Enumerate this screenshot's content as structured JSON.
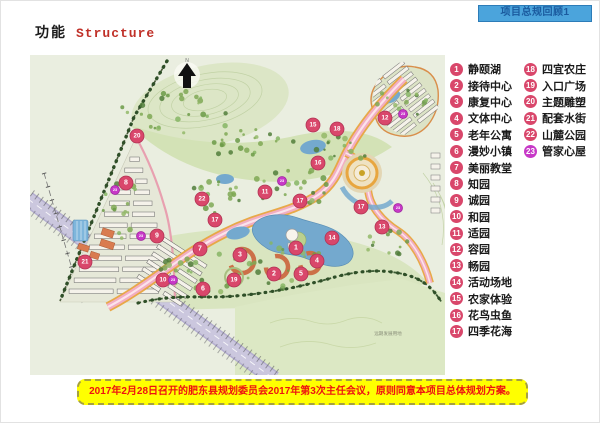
{
  "header": {
    "tab_label": "项目总规回顾1"
  },
  "title": {
    "zh": "功能",
    "en": "Structure"
  },
  "legend": {
    "column1": [
      {
        "num": "1",
        "label": "静颐湖"
      },
      {
        "num": "2",
        "label": "接待中心"
      },
      {
        "num": "3",
        "label": "康复中心"
      },
      {
        "num": "4",
        "label": "文体中心"
      },
      {
        "num": "5",
        "label": "老年公寓"
      },
      {
        "num": "6",
        "label": "漫妙小镇"
      },
      {
        "num": "7",
        "label": "美丽教堂"
      },
      {
        "num": "8",
        "label": "知园"
      },
      {
        "num": "9",
        "label": "诚园"
      },
      {
        "num": "10",
        "label": "和园"
      },
      {
        "num": "11",
        "label": "适园"
      },
      {
        "num": "12",
        "label": "容园"
      },
      {
        "num": "13",
        "label": "畅园"
      },
      {
        "num": "14",
        "label": "活动场地"
      },
      {
        "num": "15",
        "label": "农家体验"
      },
      {
        "num": "16",
        "label": "花鸟虫鱼"
      },
      {
        "num": "17",
        "label": "四季花海"
      }
    ],
    "column2": [
      {
        "num": "18",
        "label": "四宜农庄"
      },
      {
        "num": "19",
        "label": "入口广场"
      },
      {
        "num": "20",
        "label": "主题雕塑"
      },
      {
        "num": "21",
        "label": "配套水街"
      },
      {
        "num": "22",
        "label": "山麓公园"
      },
      {
        "num": "23",
        "label": "管家心屋",
        "magenta": true
      }
    ]
  },
  "map": {
    "north_label": "N",
    "future_land_label": "远期发展用地",
    "markers": [
      {
        "n": "1",
        "x": 266,
        "y": 193,
        "t": "p"
      },
      {
        "n": "2",
        "x": 244,
        "y": 219,
        "t": "p"
      },
      {
        "n": "3",
        "x": 210,
        "y": 200,
        "t": "p"
      },
      {
        "n": "4",
        "x": 287,
        "y": 206,
        "t": "p"
      },
      {
        "n": "5",
        "x": 271,
        "y": 219,
        "t": "p"
      },
      {
        "n": "6",
        "x": 173,
        "y": 234,
        "t": "p"
      },
      {
        "n": "7",
        "x": 170,
        "y": 194,
        "t": "p"
      },
      {
        "n": "8",
        "x": 96,
        "y": 128,
        "t": "p"
      },
      {
        "n": "9",
        "x": 127,
        "y": 181,
        "t": "p"
      },
      {
        "n": "10",
        "x": 133,
        "y": 225,
        "t": "p"
      },
      {
        "n": "11",
        "x": 235,
        "y": 137,
        "t": "p"
      },
      {
        "n": "12",
        "x": 355,
        "y": 63,
        "t": "p"
      },
      {
        "n": "13",
        "x": 352,
        "y": 172,
        "t": "p"
      },
      {
        "n": "14",
        "x": 302,
        "y": 183,
        "t": "p"
      },
      {
        "n": "15",
        "x": 283,
        "y": 70,
        "t": "p"
      },
      {
        "n": "16",
        "x": 288,
        "y": 108,
        "t": "p"
      },
      {
        "n": "17",
        "x": 185,
        "y": 165,
        "t": "p"
      },
      {
        "n": "17",
        "x": 270,
        "y": 146,
        "t": "p"
      },
      {
        "n": "17",
        "x": 331,
        "y": 152,
        "t": "p"
      },
      {
        "n": "18",
        "x": 307,
        "y": 74,
        "t": "p"
      },
      {
        "n": "19",
        "x": 204,
        "y": 225,
        "t": "p"
      },
      {
        "n": "20",
        "x": 107,
        "y": 81,
        "t": "p"
      },
      {
        "n": "21",
        "x": 55,
        "y": 207,
        "t": "p"
      },
      {
        "n": "22",
        "x": 172,
        "y": 144,
        "t": "p"
      },
      {
        "n": "23",
        "x": 85,
        "y": 135,
        "t": "m"
      },
      {
        "n": "23",
        "x": 252,
        "y": 126,
        "t": "m"
      },
      {
        "n": "23",
        "x": 373,
        "y": 59,
        "t": "m"
      },
      {
        "n": "23",
        "x": 143,
        "y": 225,
        "t": "m"
      },
      {
        "n": "23",
        "x": 368,
        "y": 153,
        "t": "m"
      },
      {
        "n": "23",
        "x": 111,
        "y": 181,
        "t": "m"
      }
    ]
  },
  "footer": {
    "note": "2017年2月28日召开的肥东县规划委员会2017年第3次主任会议，原则同意本项目总体规划方案。"
  },
  "colors": {
    "badge": "#D9476B",
    "badge_magenta": "#C738C7",
    "header_bg": "#4BA4DC",
    "title_red": "#C03028",
    "note_bg": "#FFFF00",
    "note_red": "#EE1111"
  }
}
